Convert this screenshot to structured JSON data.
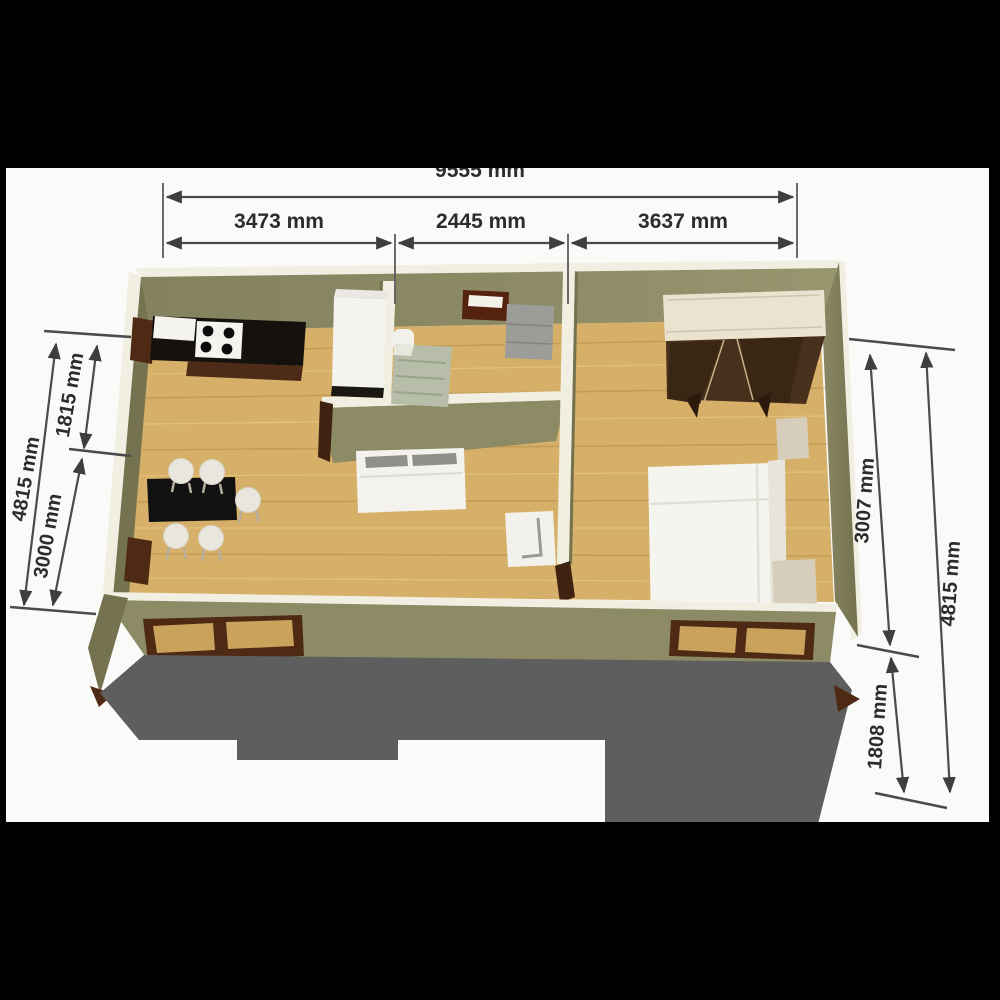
{
  "figure": {
    "kind": "3d-floor-plan-render",
    "description": "Isometric 3D floor plan of a one-bedroom unit with kitchen, living/dining area, bathroom and bedroom, annotated with millimetre dimensions"
  },
  "dimensions": {
    "top": {
      "total": "9555 mm",
      "segments": [
        "3473 mm",
        "2445 mm",
        "3637 mm"
      ]
    },
    "left": {
      "overall": "4815 mm",
      "segments": [
        "1815 mm",
        "3000 mm"
      ]
    },
    "right": {
      "overall": "4815 mm",
      "segments": [
        "3007 mm",
        "1808 mm"
      ]
    }
  },
  "colors": {
    "background": "#fafaf8",
    "frame_bar": "#000000",
    "dimension_line": "#4b4b4b",
    "dimension_text": "#2c2c2c",
    "wall_top": "#f1efe2",
    "wall_face": "#8d8b66",
    "wall_face_dark": "#75734f",
    "wall_face_light": "#98966f",
    "floor_wood": "#d6b068",
    "deck_shadow": "#5e5e5e",
    "window_frame": "#4e2a14",
    "window_pane": "#c9a25b",
    "counter_black": "#15120e",
    "cabinet_brown": "#4d2b18",
    "white_goods": "#f4f3ee",
    "gray_cabinet": "#9c9c98",
    "marble": "#b7bda9",
    "mirror_frame": "#55220e",
    "sofa": "#f3f2ec",
    "cushion_gray": "#90908a",
    "table_black": "#111111",
    "chair": "#e9e6dd",
    "wardrobe_body": "#49301d",
    "wardrobe_top": "#ebe2cf",
    "bed": "#f5f5f0",
    "headboard": "#e7e5db",
    "nightstand": "#d6cdba",
    "door_brown": "#3f2310"
  }
}
